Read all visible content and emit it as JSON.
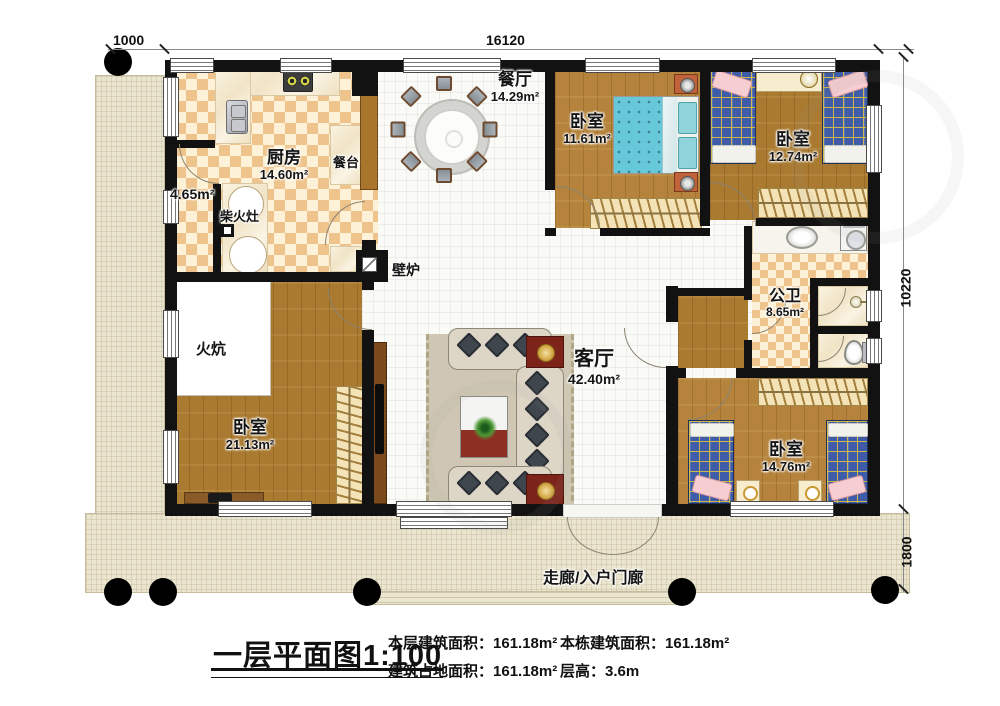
{
  "dims": {
    "porch_width": "1000",
    "house_width": "16120",
    "house_height": "10220",
    "porch_depth": "1800"
  },
  "rooms": {
    "kitchen": {
      "name": "厨房",
      "area": "14.60m²"
    },
    "pantry": {
      "area": "4.65m²"
    },
    "wood_stove": {
      "label": "柴火灶"
    },
    "counter": {
      "label": "餐台"
    },
    "dining": {
      "name": "餐厅",
      "area": "14.29m²"
    },
    "bedroom_top": {
      "name": "卧室",
      "area": "11.61m²"
    },
    "bedroom_topright": {
      "name": "卧室",
      "area": "12.74m²"
    },
    "bath": {
      "name": "公卫",
      "area": "8.65m²"
    },
    "living": {
      "name": "客厅",
      "area": "42.40m²"
    },
    "fireplace": {
      "label": "壁炉"
    },
    "kang": {
      "label": "火炕"
    },
    "bedroom_left": {
      "name": "卧室",
      "area": "21.13m²"
    },
    "bedroom_bottomright": {
      "name": "卧室",
      "area": "14.76m²"
    },
    "entry": {
      "label": "走廊/入户门廊"
    }
  },
  "footer": {
    "title": "一层平面图",
    "scale": "1:100",
    "stats": [
      {
        "label": "本层建筑面积：",
        "value": "161.18m²"
      },
      {
        "label": "本栋建筑面积：",
        "value": "161.18m²"
      },
      {
        "label": "建筑占地面积：",
        "value": "161.18m²"
      },
      {
        "label": "层高：",
        "value": "3.6m"
      }
    ]
  },
  "colors": {
    "wall": "#121212",
    "wood": "#b5833b",
    "checker_dark": "#eec48c",
    "checker_light": "#fdf2d8",
    "porch": "#ebe5cf",
    "bed_blue": "#3f5ca8",
    "bed_teal": "#66c8d8",
    "accent_red": "#7c241a"
  }
}
